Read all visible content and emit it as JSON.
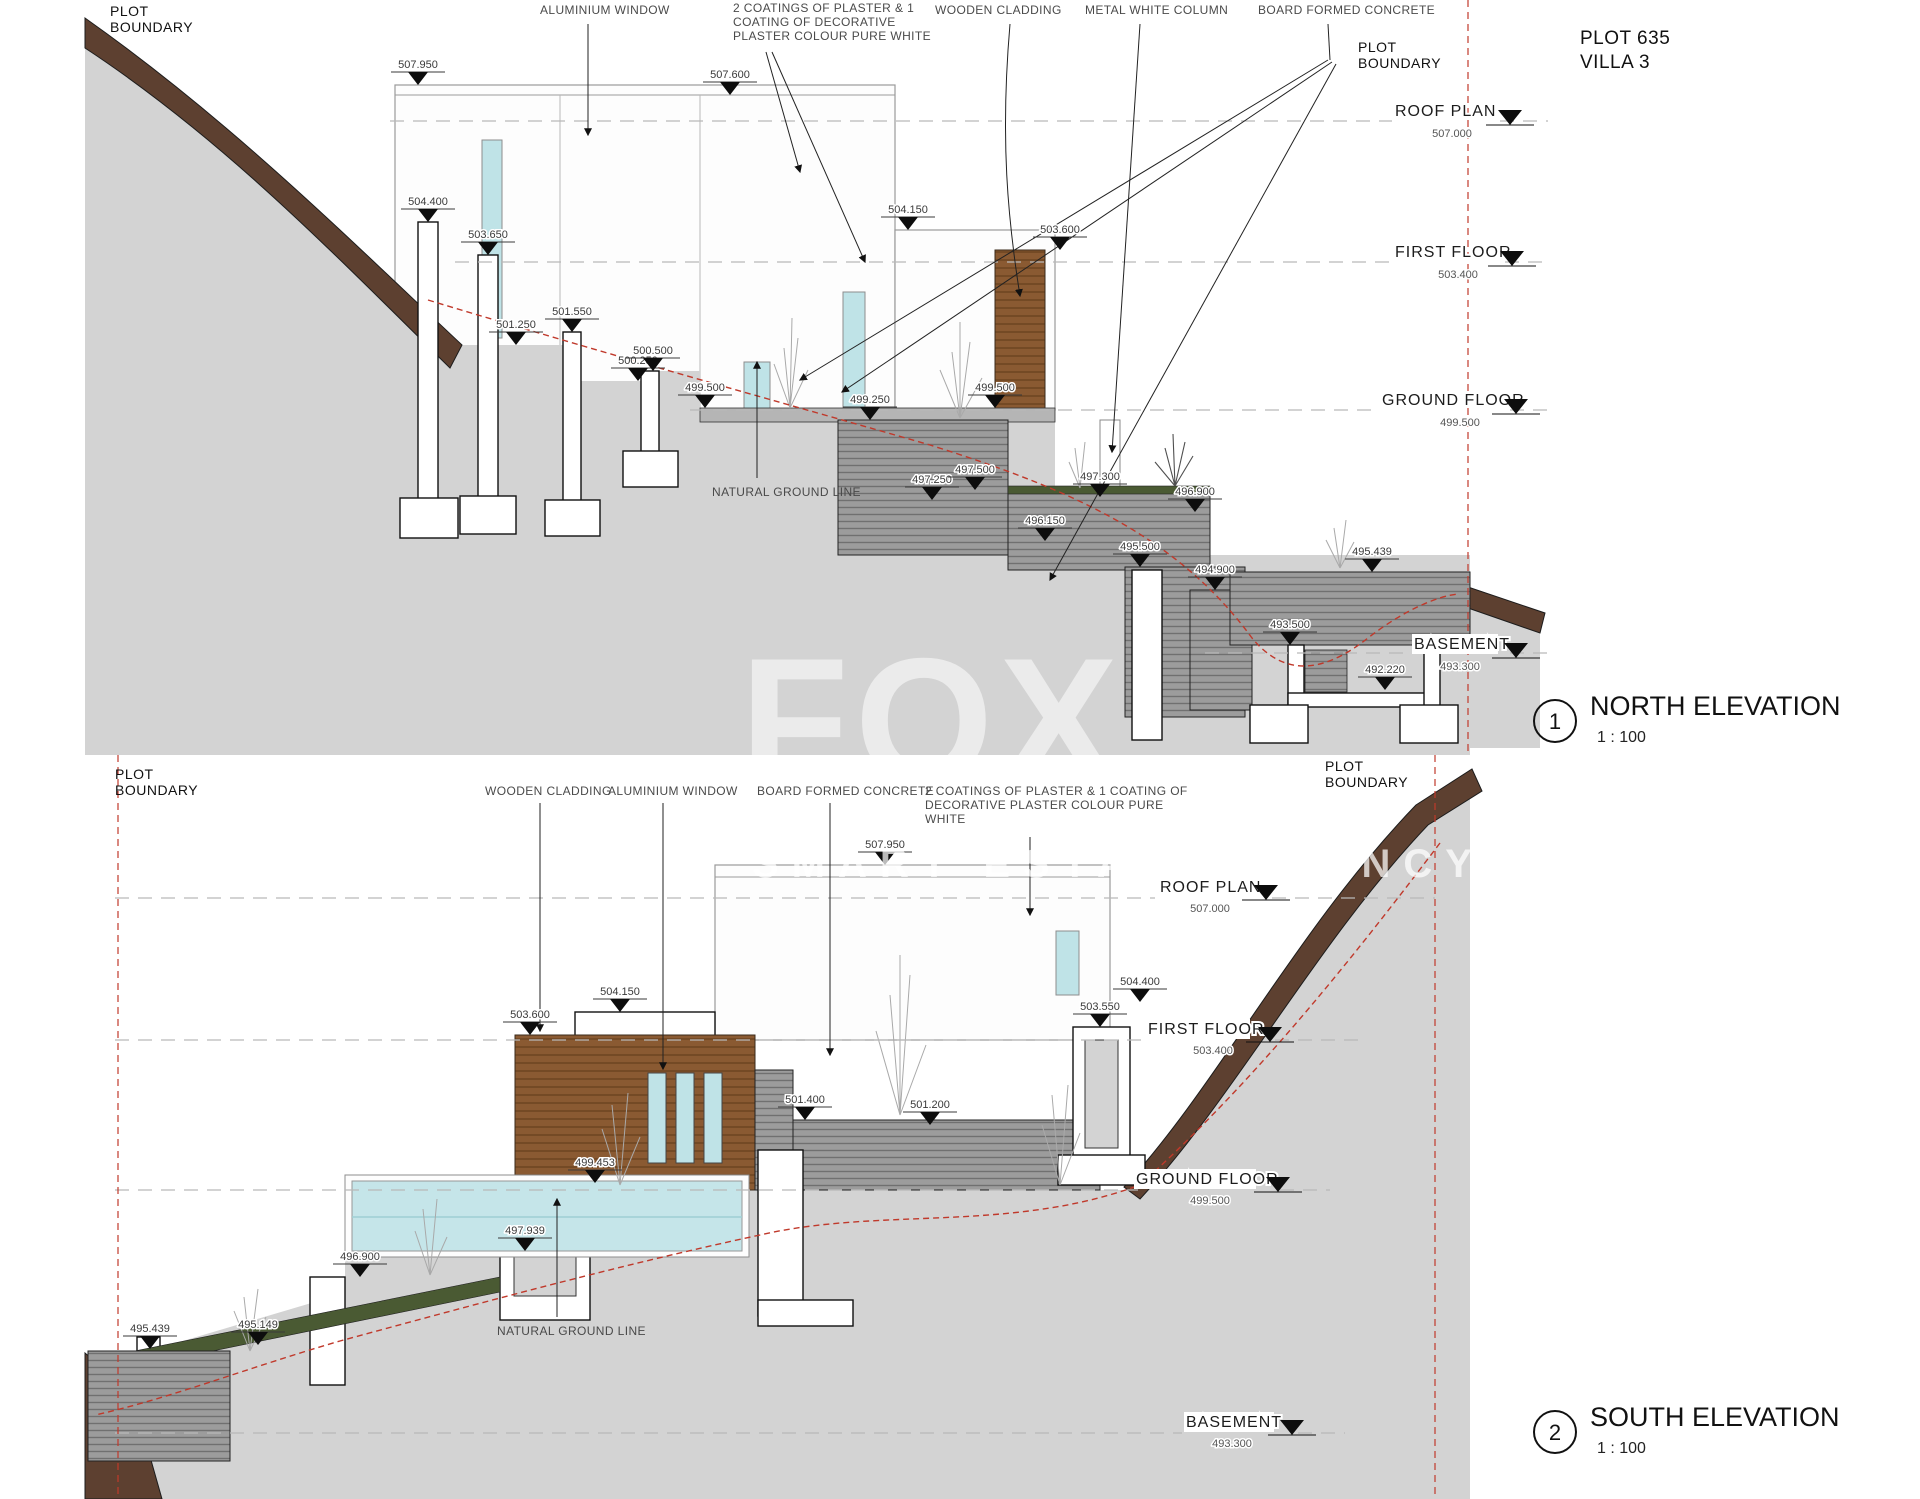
{
  "project": {
    "plot": "PLOT 635",
    "villa": "VILLA 3"
  },
  "watermark": {
    "main": "FOX",
    "sub": "SMART ESTATE AGENCY"
  },
  "boundary": {
    "l1": "PLOT",
    "l2": "BOUNDARY"
  },
  "levels": {
    "roof": {
      "label": "ROOF PLAN",
      "value": "507.000"
    },
    "first": {
      "label": "FIRST FLOOR",
      "value": "503.400"
    },
    "ground": {
      "label": "GROUND FLOOR",
      "value": "499.500"
    },
    "basement": {
      "label": "BASEMENT",
      "value": "493.300"
    }
  },
  "north": {
    "number": "1",
    "title": "NORTH ELEVATION",
    "scale": "1 : 100",
    "callouts": {
      "aluminium": "ALUMINIUM WINDOW",
      "plaster1": "2 COATINGS OF PLASTER & 1",
      "plaster2": "COATING OF DECORATIVE",
      "plaster3": "PLASTER COLOUR PURE WHITE",
      "wood": "WOODEN CLADDING",
      "metal": "METAL WHITE COLUMN",
      "concrete": "BOARD FORMED CONCRETE",
      "ground_line": "NATURAL GROUND LINE"
    },
    "spots": [
      "507.950",
      "507.600",
      "504.400",
      "503.650",
      "501.250",
      "501.550",
      "500.250",
      "500.500",
      "499.500",
      "499.250",
      "499.500",
      "504.150",
      "503.600",
      "497.250",
      "497.500",
      "497.300",
      "496.900",
      "496.150",
      "495.500",
      "494.900",
      "495.439",
      "493.500",
      "492.220"
    ]
  },
  "south": {
    "number": "2",
    "title": "SOUTH ELEVATION",
    "scale": "1 : 100",
    "callouts": {
      "wood": "WOODEN CLADDING",
      "aluminium": "ALUMINIUM WINDOW",
      "concrete": "BOARD FORMED CONCRETE",
      "plaster1": "2 COATINGS OF PLASTER & 1 COATING OF",
      "plaster2": "DECORATIVE PLASTER COLOUR PURE",
      "plaster3": "WHITE",
      "ground_line": "NATURAL GROUND LINE"
    },
    "spots": [
      "507.950",
      "504.150",
      "503.600",
      "501.400",
      "501.200",
      "503.550",
      "504.400",
      "499.453",
      "497.939",
      "496.900",
      "495.149",
      "495.439"
    ]
  },
  "colors": {
    "terrain_gray": "#d3d3d3",
    "topsoil_brown": "#5d4030",
    "wood_cladding": "#8a5a32",
    "glass_blue": "#bfe3e7",
    "concrete_gray": "#9c9c9c",
    "green_roof": "#4a5a33",
    "ground_line_red": "#c0392b"
  }
}
